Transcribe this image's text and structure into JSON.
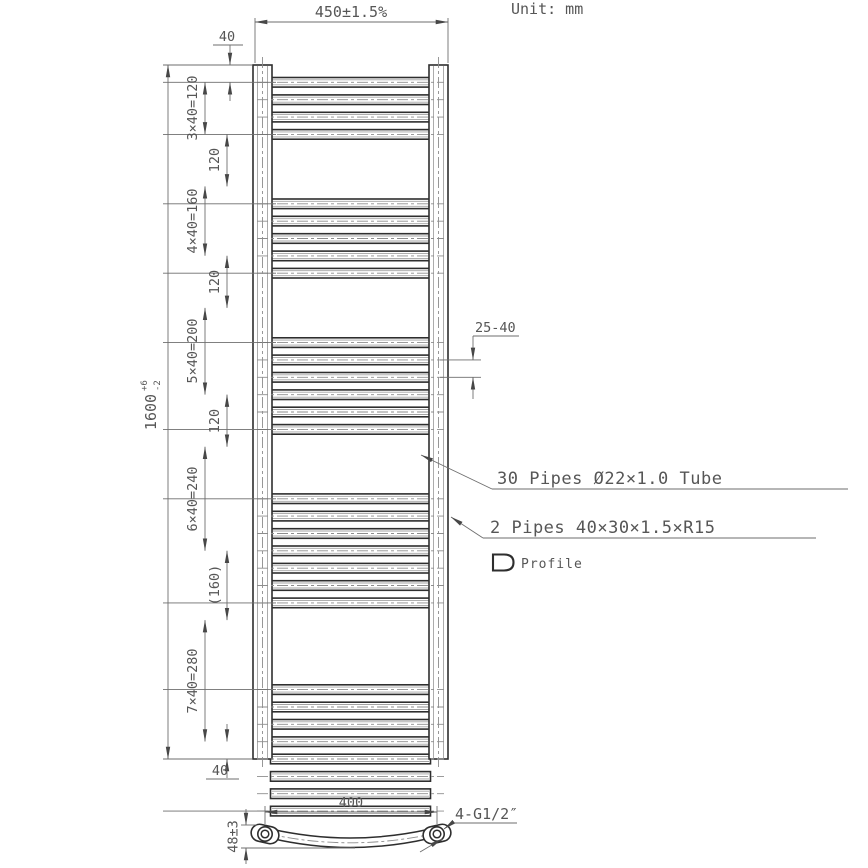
{
  "unit_label": "Unit: mm",
  "front_view": {
    "dim_width": "450±1.5%",
    "dim_top_offset": "40",
    "overall": {
      "value": "1600",
      "tol_upper": "+6",
      "tol_lower": "-2"
    },
    "chain_dims": [
      "3×40=120",
      "120",
      "4×40=160",
      "120",
      "5×40=200",
      "120",
      "6×40=240",
      "(160)",
      "7×40=280"
    ],
    "dim_bottom_offset": "40",
    "dim_pipe_spacing": "25-40",
    "label_pipes": "30 Pipes Ø22×1.0 Tube",
    "label_profiles": "2 Pipes 40×30×1.5×R15",
    "label_profile_icon": "Profile"
  },
  "bottom_view": {
    "dim_hole_centers": "400",
    "label_connections": "4-G1/2″",
    "dim_depth": "48±3"
  },
  "structure": {
    "total_pipes": 30,
    "pipe_groups": [
      4,
      5,
      6,
      7,
      8
    ],
    "pitch_mm": 40,
    "group_gaps_mm": [
      120,
      120,
      120,
      160
    ],
    "top_offset_mm": 40,
    "height_mm": 1600,
    "width_mm": 450
  }
}
